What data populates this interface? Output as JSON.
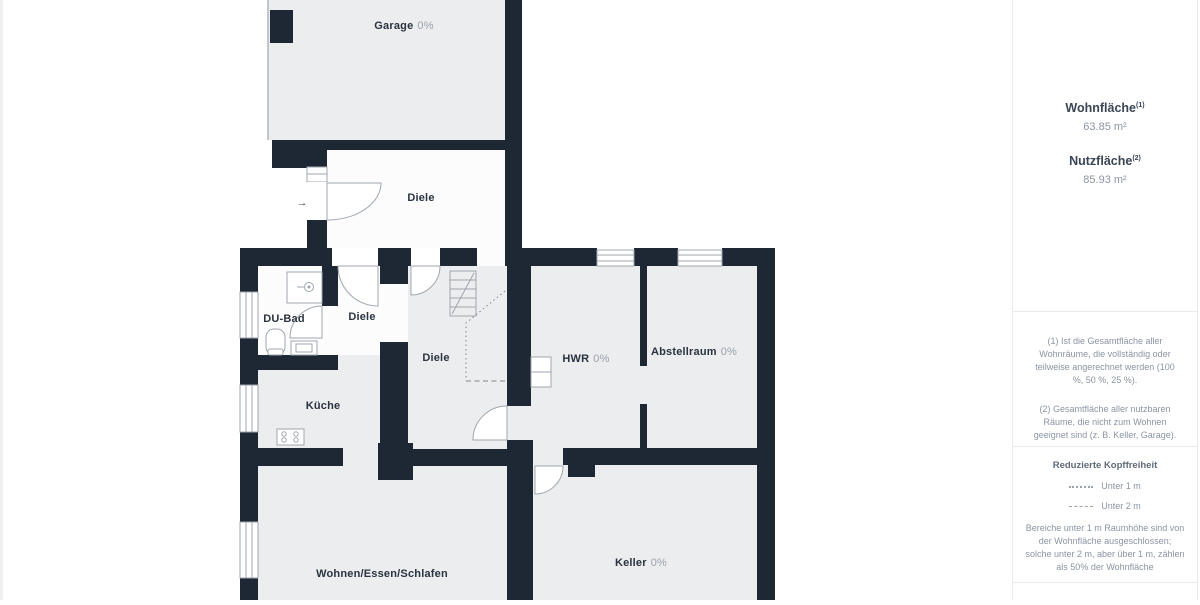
{
  "plan": {
    "rooms": [
      {
        "name": "Garage",
        "percent": "0%"
      },
      {
        "name": "Diele",
        "percent": ""
      },
      {
        "name": "DU-Bad",
        "percent": ""
      },
      {
        "name": "Diele",
        "percent": ""
      },
      {
        "name": "Diele",
        "percent": ""
      },
      {
        "name": "Küche",
        "percent": ""
      },
      {
        "name": "HWR",
        "percent": "0%"
      },
      {
        "name": "Abstellraum",
        "percent": "0%"
      },
      {
        "name": "Wohnen/Essen/Schlafen",
        "percent": ""
      },
      {
        "name": "Keller",
        "percent": "0%"
      }
    ],
    "entrance_arrow": "→"
  },
  "sidebar": {
    "areas": [
      {
        "label": "Wohnfläche",
        "sup": "(1)",
        "value": "63.85 m²"
      },
      {
        "label": "Nutzfläche",
        "sup": "(2)",
        "value": "85.93 m²"
      }
    ],
    "footnotes": [
      "(1) Ist die Gesamtfläche aller Wohnräume, die vollständig oder teilweise angerechnet werden (100 %, 50 %, 25 %).",
      "(2) Gesamtfläche aller nutzbaren Räume, die nicht zum Wohnen geeignet sind (z. B. Keller, Garage)."
    ],
    "headroom": {
      "title": "Reduzierte Kopffreiheit",
      "items": [
        {
          "label": "Unter 1 m"
        },
        {
          "label": "Unter 2 m"
        }
      ],
      "note": "Bereiche unter 1 m Raumhöhe sind von der Wohnfläche ausgeschlossen; solche unter 2 m, aber über 1 m, zählen als 50% der Wohnfläche"
    }
  },
  "colors": {
    "wall": "#1e2834",
    "room_gray": "#ecedee",
    "room_white": "#fcfcfd",
    "label_dark": "#2a3340",
    "label_muted": "#9aa2ab"
  }
}
